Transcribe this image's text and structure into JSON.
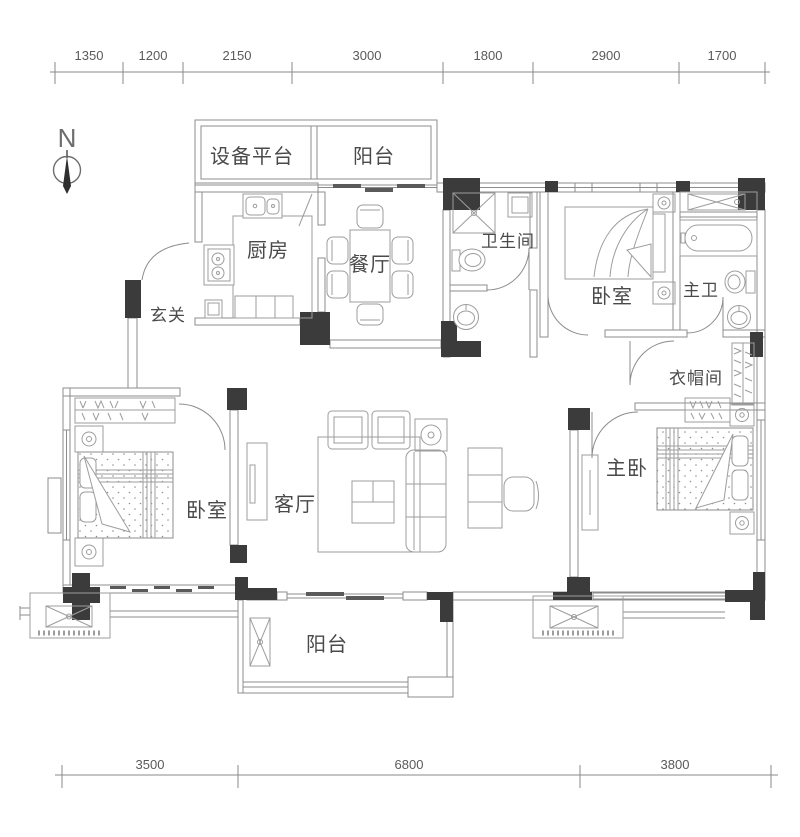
{
  "compass": {
    "label": "N"
  },
  "dimensions": {
    "top": [
      "1350",
      "1200",
      "2150",
      "3000",
      "1800",
      "2900",
      "1700"
    ],
    "bottom": [
      "3500",
      "6800",
      "3800"
    ]
  },
  "rooms": {
    "equipment_platform": "设备平台",
    "balcony_top": "阳台",
    "kitchen": "厨房",
    "dining_room": "餐厅",
    "bathroom": "卫生间",
    "bedroom_right": "卧室",
    "master_bathroom": "主卫",
    "entry": "玄关",
    "cloakroom": "衣帽间",
    "bedroom_left": "卧室",
    "living_room": "客厅",
    "master_bedroom": "主卧",
    "balcony_bottom": "阳台"
  },
  "colors": {
    "wall_fill": "#3b3b3b",
    "line": "#8c8c8c",
    "text": "#4a4a4a"
  }
}
